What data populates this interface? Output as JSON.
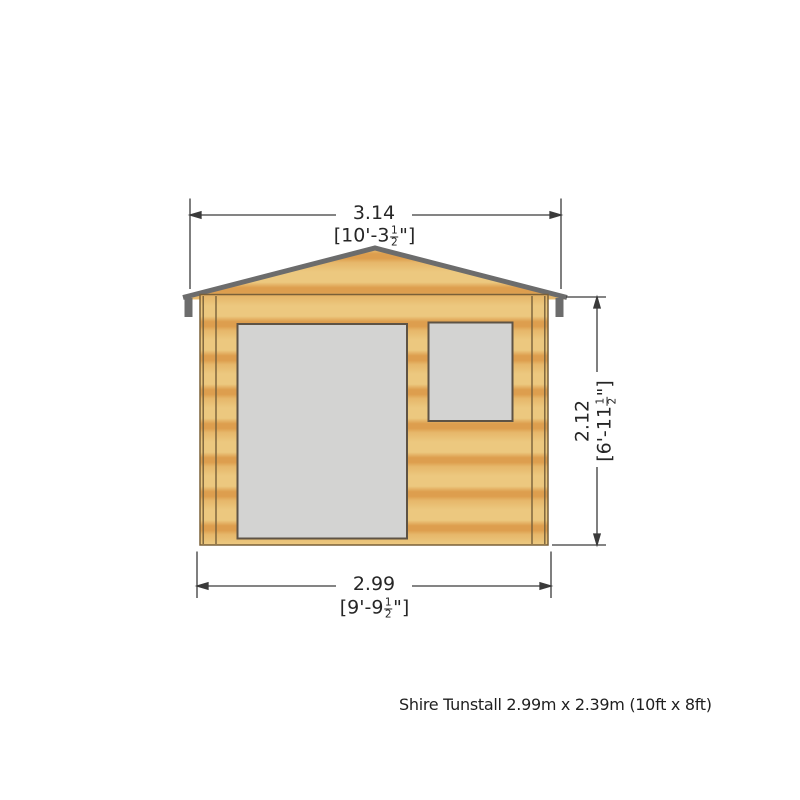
{
  "diagram": {
    "type": "front-elevation-drawing",
    "caption": "Shire Tunstall 2.99m x 2.39m (10ft x 8ft)",
    "dimensions": {
      "overall_width": {
        "metric_m": "3.14",
        "imperial_prefix": "[10'-3",
        "frac_num": "1",
        "frac_den": "2",
        "imperial_suffix": "\"]"
      },
      "eaves_height": {
        "metric_m": "2.12",
        "imperial_prefix": "[6'-11",
        "frac_num": "1",
        "frac_den": "2",
        "imperial_suffix": "\"]"
      },
      "base_width": {
        "metric_m": "2.99",
        "imperial_prefix": "[9'-9",
        "frac_num": "1",
        "frac_den": "2",
        "imperial_suffix": "\"]"
      }
    },
    "colors": {
      "wood_light": "#ecc87f",
      "wood_mid": "#e6b76a",
      "wood_dark": "#dd9e4e",
      "roof_fascia": "#6c6c6c",
      "roof_end_cap": "#6c6c6c",
      "wall_outline": "#7a6038",
      "corner_post_line": "#77603a",
      "opening_fill": "#d3d3d2",
      "opening_border": "#5e5345",
      "dim_line": "#3a3a3a"
    }
  }
}
